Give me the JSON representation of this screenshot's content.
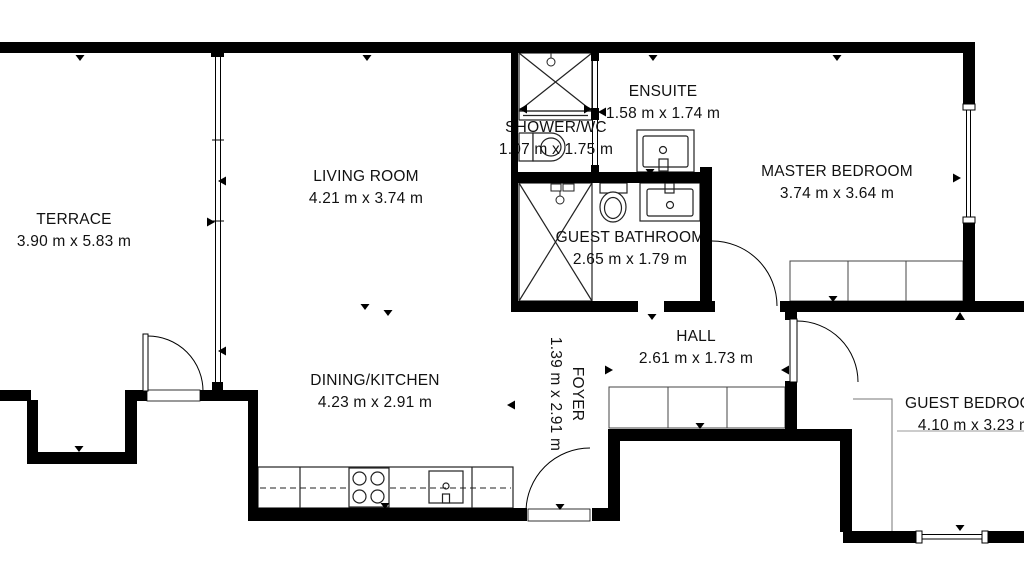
{
  "meta": {
    "drawing_type": "apartment floor plan",
    "units": "m",
    "palette": {
      "background": "#ffffff",
      "walls": "#000000",
      "fixtures": "#222222",
      "furniture": "#555555",
      "text": "#111111"
    }
  },
  "rooms": [
    {
      "id": "terrace",
      "name": "TERRACE",
      "dims": "3.90 m x 5.83 m"
    },
    {
      "id": "living-room",
      "name": "LIVING ROOM",
      "dims": "4.21 m x 3.74 m"
    },
    {
      "id": "shower-wc",
      "name": "SHOWER/WC",
      "dims": "1.07 m x 1.75 m"
    },
    {
      "id": "ensuite",
      "name": "ENSUITE",
      "dims": "1.58 m x 1.74 m"
    },
    {
      "id": "master-bedroom",
      "name": "MASTER BEDROOM",
      "dims": "3.74 m x 3.64 m"
    },
    {
      "id": "guest-bathroom",
      "name": "GUEST BATHROOM",
      "dims": "2.65 m x 1.79 m"
    },
    {
      "id": "hall",
      "name": "HALL",
      "dims": "2.61 m x 1.73 m"
    },
    {
      "id": "dining-kitchen",
      "name": "DINING/KITCHEN",
      "dims": "4.23 m x 2.91 m"
    },
    {
      "id": "foyer",
      "name": "FOYER",
      "dims": "1.39 m x 2.91 m"
    },
    {
      "id": "guest-bedroom",
      "name": "GUEST BEDROOM",
      "dims": "4.10 m x 3.23 m"
    }
  ]
}
